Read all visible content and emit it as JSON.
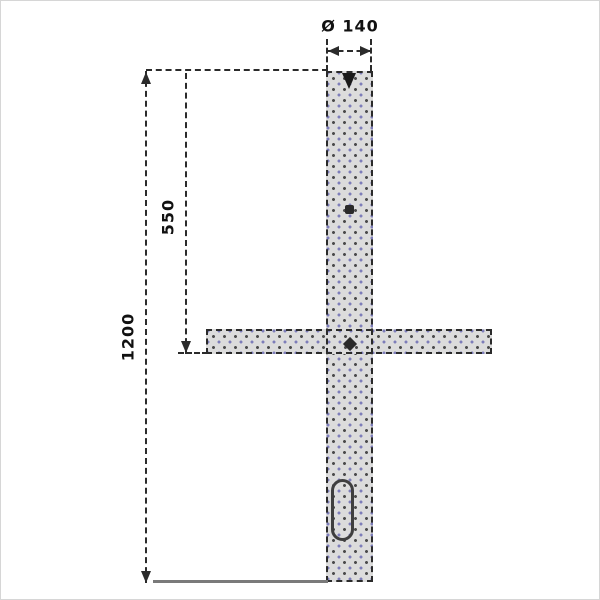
{
  "drawing": {
    "type": "technical-drawing",
    "labels": {
      "diameter": "Ø 140",
      "upper_span": "550",
      "total_height": "1200"
    },
    "colors": {
      "background": "#ffffff",
      "outline": "#2b2b2b",
      "steel_fill": "#dcdcdc",
      "hatch_dot_dark": "#4b4b4b",
      "hatch_dot_blue": "#7d7db9",
      "ground_line": "#7a7a7a"
    },
    "icons": {
      "arrowhead": "css-triangle",
      "fixing_pin": "down-triangle",
      "fixing_point": "square-dot",
      "rail_joint": "diamond-dot"
    }
  }
}
